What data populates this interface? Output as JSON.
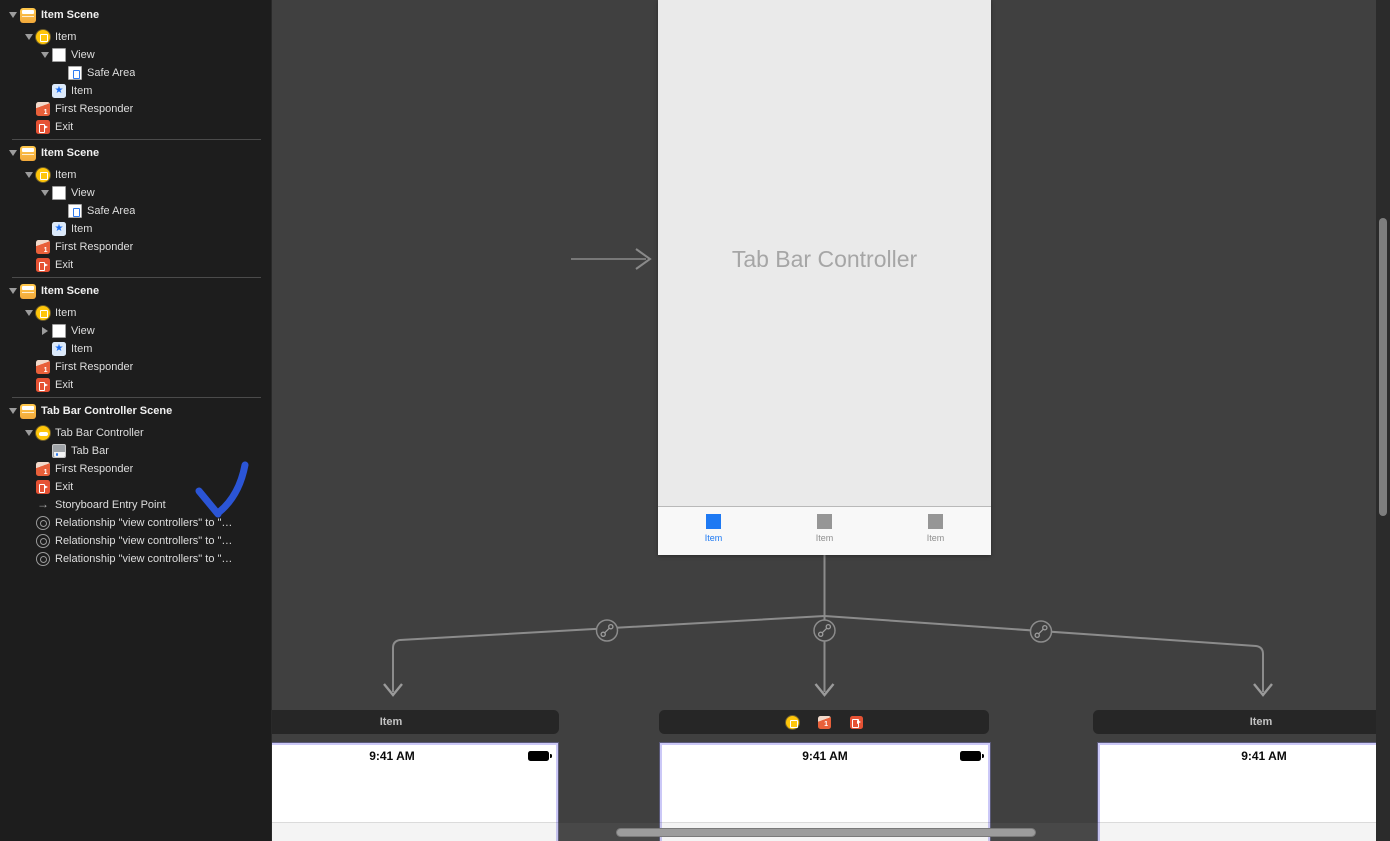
{
  "sidebar": {
    "scenes": [
      {
        "title": "Item Scene",
        "rows": [
          {
            "label": "Item",
            "icon": "view-controller-icon"
          },
          {
            "label": "View",
            "icon": "view-icon"
          },
          {
            "label": "Safe Area",
            "icon": "safe-area-icon"
          },
          {
            "label": "Item",
            "icon": "tab-bar-item-star-icon"
          },
          {
            "label": "First Responder",
            "icon": "first-responder-cube-icon"
          },
          {
            "label": "Exit",
            "icon": "exit-icon"
          }
        ]
      },
      {
        "title": "Item Scene",
        "rows": [
          {
            "label": "Item",
            "icon": "view-controller-icon"
          },
          {
            "label": "View",
            "icon": "view-icon"
          },
          {
            "label": "Safe Area",
            "icon": "safe-area-icon"
          },
          {
            "label": "Item",
            "icon": "tab-bar-item-star-icon"
          },
          {
            "label": "First Responder",
            "icon": "first-responder-cube-icon"
          },
          {
            "label": "Exit",
            "icon": "exit-icon"
          }
        ]
      },
      {
        "title": "Item Scene",
        "rows": [
          {
            "label": "Item",
            "icon": "view-controller-icon"
          },
          {
            "label": "View",
            "icon": "view-icon"
          },
          {
            "label": "Item",
            "icon": "tab-bar-item-star-icon"
          },
          {
            "label": "First Responder",
            "icon": "first-responder-cube-icon"
          },
          {
            "label": "Exit",
            "icon": "exit-icon"
          }
        ]
      },
      {
        "title": "Tab Bar Controller Scene",
        "rows": [
          {
            "label": "Tab Bar Controller",
            "icon": "tab-bar-controller-icon"
          },
          {
            "label": "Tab Bar",
            "icon": "tab-bar-icon"
          },
          {
            "label": "First Responder",
            "icon": "first-responder-cube-icon"
          },
          {
            "label": "Exit",
            "icon": "exit-icon"
          },
          {
            "label": "Storyboard Entry Point",
            "icon": "entry-point-arrow-icon"
          },
          {
            "label": "Relationship \"view controllers\" to \"…",
            "icon": "relationship-icon"
          },
          {
            "label": "Relationship \"view controllers\" to \"…",
            "icon": "relationship-icon"
          },
          {
            "label": "Relationship \"view controllers\" to \"…",
            "icon": "relationship-icon"
          }
        ]
      }
    ],
    "annotation": {
      "type": "hand-drawn-arrow",
      "color": "#2B55D6"
    }
  },
  "canvas": {
    "tab_bar_controller": {
      "title": "Tab Bar Controller",
      "tabs": [
        {
          "label": "Item",
          "selected": true
        },
        {
          "label": "Item",
          "selected": false
        },
        {
          "label": "Item",
          "selected": false
        }
      ]
    },
    "children": [
      {
        "header_label": "Item",
        "status_time": "9:41 AM",
        "battery_icon": true
      },
      {
        "header_icons": [
          "view-controller-icon",
          "first-responder-cube-icon",
          "exit-icon"
        ],
        "status_time": "9:41 AM",
        "battery_icon": true
      },
      {
        "header_label": "Item",
        "status_time": "9:41 AM",
        "battery_icon": false
      }
    ]
  },
  "colors": {
    "selected_tab_blue": "#1E79F3",
    "annotation_blue": "#2B55D6",
    "scene_icon_yellow": "#F2A93B",
    "controller_icon_yellow": "#FFC60A",
    "first_responder_orange": "#E8603A",
    "exit_orange": "#E55234",
    "selection_outline_purple": "#CBC8F7",
    "canvas_gray": "#404040",
    "sidebar_dark": "#1D1D1D"
  }
}
